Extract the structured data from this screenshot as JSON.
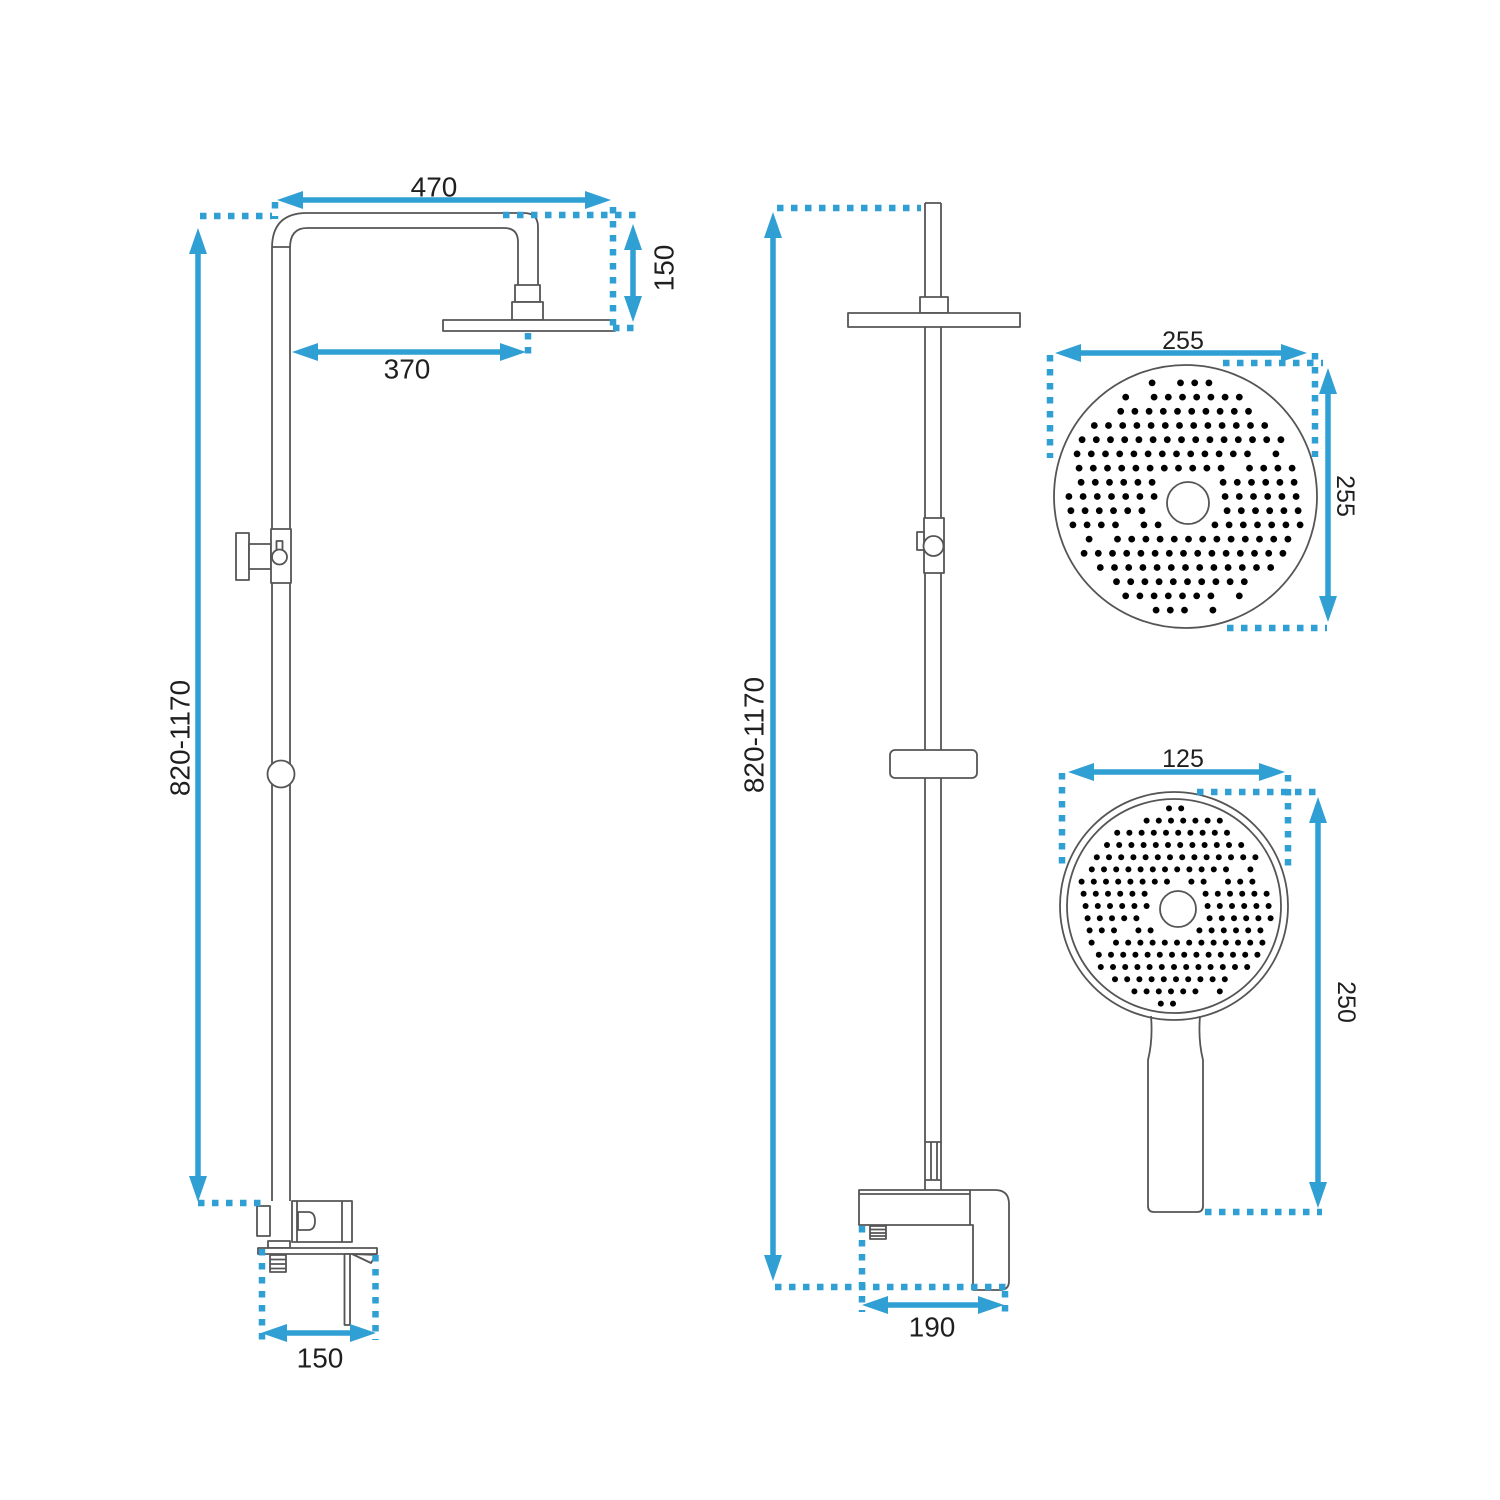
{
  "drawing": {
    "front_view": {
      "label_top_width": "470",
      "label_head_drop": "150",
      "label_head_reach": "370",
      "label_column_height": "820-1170",
      "label_base_width": "150"
    },
    "side_view": {
      "label_column_height": "820-1170",
      "label_mixer_depth": "190"
    },
    "overhead_shower_detail": {
      "label_width": "255",
      "label_height": "255"
    },
    "hand_shower_detail": {
      "label_width": "125",
      "label_height": "250"
    }
  },
  "colors": {
    "dimension_line": "#2f9fd4",
    "drawing_line": "#555555",
    "label_text": "#1f1f1f",
    "background": "#ffffff"
  }
}
